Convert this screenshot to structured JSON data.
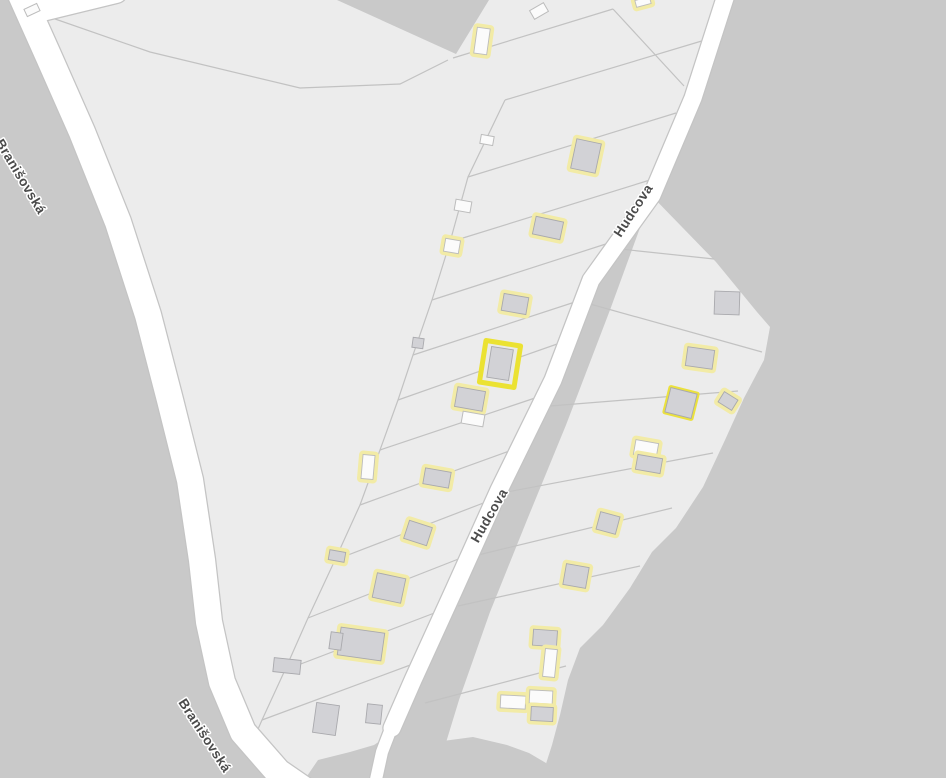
{
  "map": {
    "kind": "cadastral-parcel-map",
    "streets": [
      {
        "name": "Branišovská",
        "labels": [
          {
            "x": 20,
            "y": 177,
            "rot": 59
          },
          {
            "x": 204,
            "y": 736,
            "rot": 57
          }
        ]
      },
      {
        "name": "Hudcova",
        "labels": [
          {
            "x": 634,
            "y": 211,
            "rot": -57
          },
          {
            "x": 490,
            "y": 516,
            "rot": -60
          }
        ]
      }
    ],
    "colors": {
      "background_outside": "#c9c9c9",
      "parcel_fill": "#ececec",
      "parcel_line": "#c2c2c2",
      "road_fill": "#ffffff",
      "road_casing": "#c4c4c4",
      "building_fill": "#d2d2d6",
      "building_stroke": "#a9a9ad",
      "building_white_fill": "#fbfbfb",
      "building_white_stroke": "#bcbcbc",
      "highlight_halo": "#f2eba6",
      "highlight_strong": "#ebe13e",
      "selected_outline": "#ebe232",
      "label_color": "#4b4b4b",
      "label_halo": "#ffffff"
    },
    "geometry": {
      "areas": {
        "west_parcels": [
          [
            18,
            -12
          ],
          [
            48,
            55
          ],
          [
            82,
            132
          ],
          [
            118,
            222
          ],
          [
            148,
            315
          ],
          [
            170,
            400
          ],
          [
            190,
            480
          ],
          [
            202,
            560
          ],
          [
            209,
            622
          ],
          [
            222,
            682
          ],
          [
            243,
            732
          ],
          [
            278,
            772
          ],
          [
            308,
            795
          ],
          [
            430,
            795
          ],
          [
            392,
            728
          ],
          [
            413,
            680
          ],
          [
            454,
            590
          ],
          [
            499,
            490
          ],
          [
            553,
            380
          ],
          [
            591,
            280
          ],
          [
            652,
            195
          ],
          [
            693,
            98
          ],
          [
            727,
            -8
          ]
        ],
        "east_parcels": [
          [
            648,
            192
          ],
          [
            716,
            262
          ],
          [
            757,
            312
          ],
          [
            770,
            327
          ],
          [
            764,
            360
          ],
          [
            744,
            398
          ],
          [
            725,
            440
          ],
          [
            703,
            487
          ],
          [
            676,
            528
          ],
          [
            652,
            552
          ],
          [
            630,
            588
          ],
          [
            603,
            625
          ],
          [
            580,
            648
          ],
          [
            568,
            680
          ],
          [
            560,
            715
          ],
          [
            552,
            745
          ],
          [
            544,
            770
          ],
          [
            540,
            792
          ],
          [
            437,
            772
          ],
          [
            459,
            700
          ],
          [
            490,
            612
          ],
          [
            527,
            520
          ],
          [
            566,
            425
          ],
          [
            610,
            310
          ],
          [
            652,
            195
          ]
        ],
        "dark_wedge": [
          [
            337,
            0
          ],
          [
            489,
            0
          ],
          [
            456,
            54
          ]
        ],
        "dark_bottom": [
          [
            303,
            782
          ],
          [
            318,
            760
          ],
          [
            350,
            752
          ],
          [
            374,
            745
          ],
          [
            392,
            733
          ],
          [
            417,
            738
          ],
          [
            443,
            741
          ],
          [
            473,
            737
          ],
          [
            507,
            745
          ],
          [
            529,
            753
          ],
          [
            546,
            763
          ],
          [
            554,
            782
          ]
        ]
      },
      "roads": [
        {
          "id": "branisovska",
          "width": 26,
          "path": "M18,-12 L48,55 L82,132 L118,222 L148,315 L170,400 L190,480 L202,560 L209,622 L222,682 L243,732 L278,772 L310,794"
        },
        {
          "id": "branisovska-stub",
          "width": 22,
          "path": "M34,12 L116,-8"
        },
        {
          "id": "hudcova",
          "width": 17,
          "path": "M727,-8 L693,98 L652,195 L591,280 L553,380 L499,490 L454,590 L413,680 L392,728"
        },
        {
          "id": "hudcova-path",
          "width": 12,
          "path": "M392,726 L382,752 L375,784"
        }
      ],
      "parcel_lines": [
        "M35,12 L150,52 L300,88 L400,84 L448,60",
        "M453,58 L613,9",
        "M613,9 L684,86",
        "M505,100 L468,177 L450,242 L432,300 L413,355 L398,400 L380,450 L360,505 L335,560 L308,618 L285,670 L262,720 L248,752",
        "M505,100 L705,40",
        "M468,177 L676,113",
        "M450,242 L650,180",
        "M432,300 L612,242",
        "M413,355 L575,302",
        "M398,400 L560,343",
        "M380,450 L538,397",
        "M360,505 L512,450",
        "M335,560 L486,502",
        "M308,618 L461,558",
        "M285,670 L437,612",
        "M262,720 L413,664",
        "M620,249 L714,259",
        "M590,304 L762,352",
        "M550,406 L738,391",
        "M507,492 L713,453",
        "M478,555 L672,508",
        "M458,606 L640,566",
        "M425,703 L566,666"
      ],
      "buildings": [
        {
          "cx": 32,
          "cy": 10,
          "w": 14,
          "h": 8,
          "rot": -25,
          "style": "white"
        },
        {
          "cx": 482,
          "cy": 41,
          "w": 13,
          "h": 26,
          "rot": 8,
          "style": "halo-white"
        },
        {
          "cx": 539,
          "cy": 11,
          "w": 16,
          "h": 10,
          "rot": -30,
          "style": "white"
        },
        {
          "cx": 643,
          "cy": 2,
          "w": 15,
          "h": 7,
          "rot": -15,
          "style": "halo-white"
        },
        {
          "cx": 586,
          "cy": 156,
          "w": 25,
          "h": 30,
          "rot": 12,
          "style": "halo"
        },
        {
          "cx": 487,
          "cy": 140,
          "w": 13,
          "h": 9,
          "rot": 10,
          "style": "white"
        },
        {
          "cx": 548,
          "cy": 228,
          "w": 28,
          "h": 18,
          "rot": 12,
          "style": "halo"
        },
        {
          "cx": 463,
          "cy": 206,
          "w": 16,
          "h": 11,
          "rot": 10,
          "style": "white"
        },
        {
          "cx": 452,
          "cy": 246,
          "w": 15,
          "h": 13,
          "rot": 10,
          "style": "halo-white"
        },
        {
          "cx": 515,
          "cy": 304,
          "w": 25,
          "h": 17,
          "rot": 10,
          "style": "halo"
        },
        {
          "cx": 418,
          "cy": 343,
          "w": 11,
          "h": 10,
          "rot": 8,
          "style": "plain"
        },
        {
          "cx": 500,
          "cy": 364,
          "w": 35,
          "h": 42,
          "rot": 9,
          "style": "selected"
        },
        {
          "cx": 470,
          "cy": 399,
          "w": 28,
          "h": 20,
          "rot": 10,
          "style": "halo"
        },
        {
          "cx": 473,
          "cy": 419,
          "w": 22,
          "h": 12,
          "rot": 10,
          "style": "white"
        },
        {
          "cx": 437,
          "cy": 478,
          "w": 26,
          "h": 16,
          "rot": 10,
          "style": "halo"
        },
        {
          "cx": 368,
          "cy": 467,
          "w": 12,
          "h": 24,
          "rot": 5,
          "style": "halo-white"
        },
        {
          "cx": 418,
          "cy": 533,
          "w": 24,
          "h": 19,
          "rot": 18,
          "style": "halo"
        },
        {
          "cx": 337,
          "cy": 556,
          "w": 16,
          "h": 10,
          "rot": 10,
          "style": "halo"
        },
        {
          "cx": 389,
          "cy": 588,
          "w": 29,
          "h": 25,
          "rot": 12,
          "style": "halo"
        },
        {
          "cx": 361,
          "cy": 644,
          "w": 44,
          "h": 28,
          "rot": 8,
          "style": "halo"
        },
        {
          "cx": 336,
          "cy": 641,
          "w": 12,
          "h": 17,
          "rot": 8,
          "style": "plain"
        },
        {
          "cx": 287,
          "cy": 666,
          "w": 27,
          "h": 14,
          "rot": 6,
          "style": "plain"
        },
        {
          "cx": 326,
          "cy": 719,
          "w": 23,
          "h": 30,
          "rot": 8,
          "style": "plain"
        },
        {
          "cx": 374,
          "cy": 714,
          "w": 15,
          "h": 19,
          "rot": 6,
          "style": "plain"
        },
        {
          "cx": 727,
          "cy": 303,
          "w": 25,
          "h": 23,
          "rot": 2,
          "style": "plain"
        },
        {
          "cx": 700,
          "cy": 358,
          "w": 27,
          "h": 19,
          "rot": 8,
          "style": "halo"
        },
        {
          "cx": 681,
          "cy": 403,
          "w": 27,
          "h": 25,
          "rot": 14,
          "style": "halo-strong"
        },
        {
          "cx": 728,
          "cy": 401,
          "w": 16,
          "h": 12,
          "rot": 32,
          "style": "halo"
        },
        {
          "cx": 646,
          "cy": 449,
          "w": 23,
          "h": 15,
          "rot": 10,
          "style": "halo-white"
        },
        {
          "cx": 649,
          "cy": 464,
          "w": 25,
          "h": 15,
          "rot": 10,
          "style": "halo"
        },
        {
          "cx": 608,
          "cy": 523,
          "w": 20,
          "h": 18,
          "rot": 15,
          "style": "halo"
        },
        {
          "cx": 576,
          "cy": 576,
          "w": 23,
          "h": 21,
          "rot": 10,
          "style": "halo"
        },
        {
          "cx": 545,
          "cy": 638,
          "w": 24,
          "h": 16,
          "rot": 4,
          "style": "halo"
        },
        {
          "cx": 550,
          "cy": 663,
          "w": 12,
          "h": 28,
          "rot": 6,
          "style": "halo-white"
        },
        {
          "cx": 513,
          "cy": 702,
          "w": 25,
          "h": 13,
          "rot": 3,
          "style": "halo-white"
        },
        {
          "cx": 541,
          "cy": 697,
          "w": 23,
          "h": 13,
          "rot": 3,
          "style": "halo-white"
        },
        {
          "cx": 542,
          "cy": 714,
          "w": 22,
          "h": 14,
          "rot": 3,
          "style": "halo"
        }
      ]
    }
  }
}
